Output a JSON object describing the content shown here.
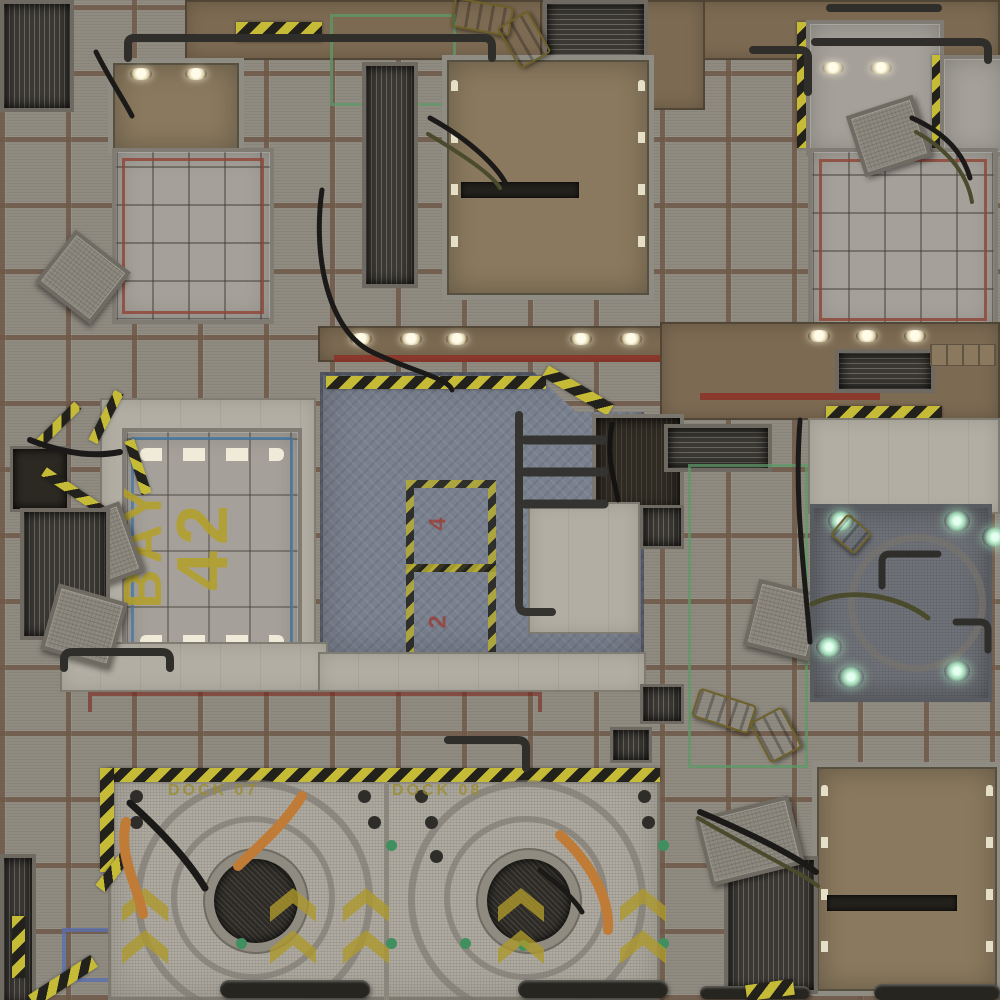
{
  "map": {
    "type": "sci-fi industrial floor game mat",
    "labels": {
      "bay_word": "BAY",
      "bay_number": "42",
      "dock_left": "DOCK 07",
      "dock_right": "DOCK 08",
      "hazard_mark_top": "4",
      "hazard_mark_bottom": "2"
    },
    "colors": {
      "tile_gray": "#8f8b81",
      "grout_rust": "#6e5847",
      "concrete_light": "#b2aea3",
      "panel_metal": "#a5a19a",
      "brown_panel": "#8a795e",
      "brown_wall": "#7c6a52",
      "plate_blue_gray": "#79808e",
      "hazard_yellow": "#c5bb37",
      "hazard_black": "#22211c",
      "paint_red": "#8d3126",
      "paint_green": "#5d9a68",
      "paint_blue": "#5a6fae",
      "stencil_yellow": "#b3a02a",
      "cable_orange": "#c07b36",
      "glow_green": "#d6ffe8"
    }
  }
}
